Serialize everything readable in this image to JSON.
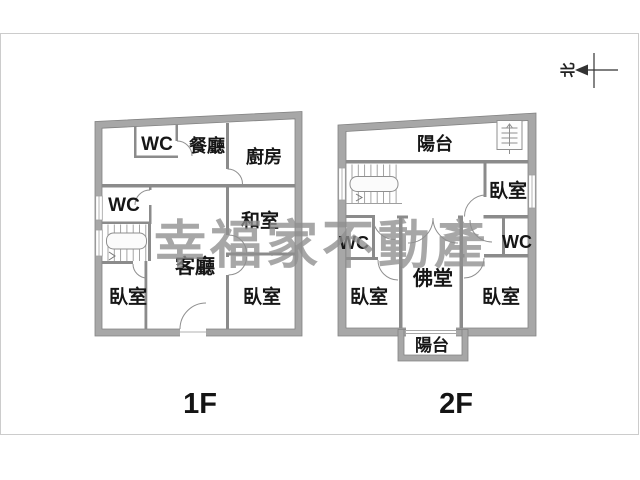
{
  "watermark": {
    "text": "幸福家不動產",
    "color": "#8f8f8f"
  },
  "north_indicator": {
    "label": "北"
  },
  "colors": {
    "wall_gray": "#a7a7a7",
    "wall_edge": "#828282",
    "inner_wall": "#8b8b8b",
    "label_black": "#161616",
    "frame_gray": "#cccccc"
  },
  "floor1": {
    "name_label": "1F",
    "rooms": {
      "wc_top": "WC",
      "dining": "餐廳",
      "kitchen": "廚房",
      "wc_mid": "WC",
      "tatami": "和室",
      "living": "客廳",
      "bedroom_left": "臥室",
      "bedroom_right": "臥室"
    }
  },
  "floor2": {
    "name_label": "2F",
    "rooms": {
      "balcony_top": "陽台",
      "bedroom_top": "臥室",
      "wc_left": "WC",
      "wc_right": "WC",
      "buddha_hall": "佛堂",
      "bedroom_left": "臥室",
      "bedroom_right": "臥室",
      "balcony_bottom": "陽台"
    }
  }
}
